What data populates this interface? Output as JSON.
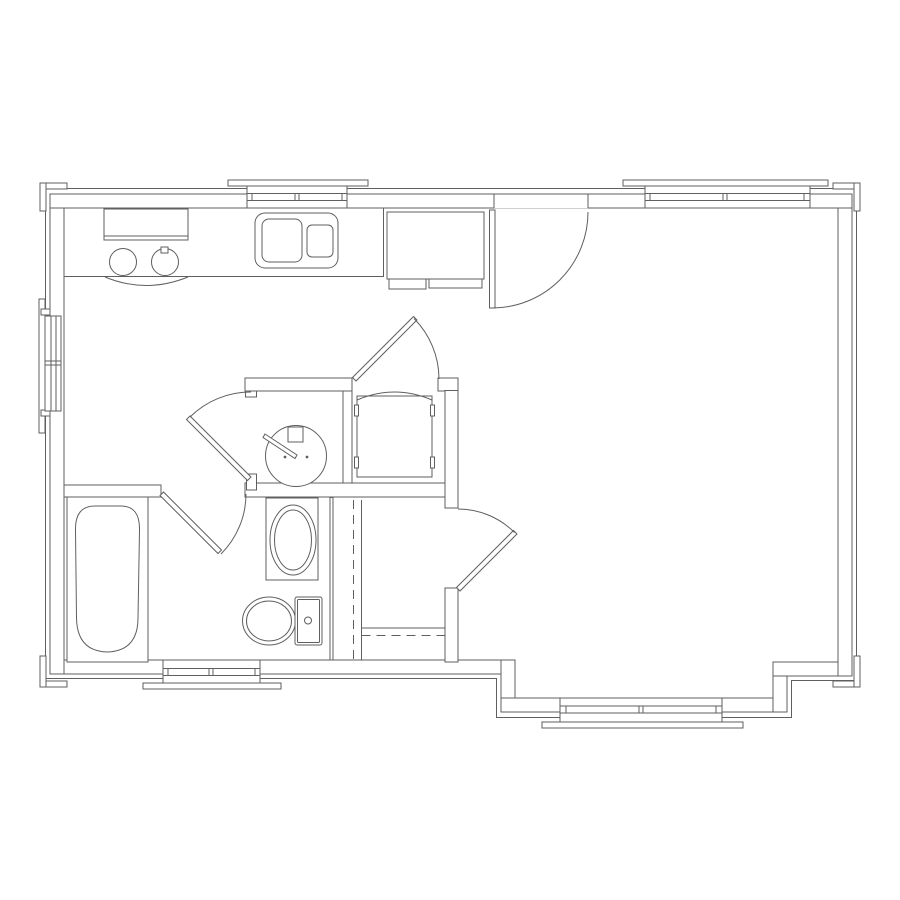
{
  "canvas": {
    "width": 900,
    "height": 900,
    "background": "#ffffff"
  },
  "style": {
    "line_color": "#5f5f5f",
    "line_width": 1,
    "dash": "9 6",
    "fill_white": "#ffffff"
  },
  "plan": {
    "groups": [
      {
        "name": "exterior-walls",
        "shapes": [
          {
            "t": "r",
            "x": 50,
            "y": 660,
            "w": 465,
            "h": 14,
            "f": 1
          },
          {
            "t": "r",
            "x": 501,
            "y": 660,
            "w": 14,
            "h": 52,
            "f": 1
          },
          {
            "t": "r",
            "x": 501,
            "y": 698,
            "w": 286,
            "h": 14,
            "f": 1
          },
          {
            "t": "r",
            "x": 773,
            "y": 662,
            "w": 14,
            "h": 50,
            "f": 1
          },
          {
            "t": "r",
            "x": 773,
            "y": 662,
            "w": 79,
            "h": 14,
            "f": 1
          },
          {
            "t": "r",
            "x": 50,
            "y": 194,
            "w": 14,
            "h": 480,
            "f": 1
          },
          {
            "t": "r",
            "x": 838,
            "y": 194,
            "w": 14,
            "h": 482,
            "f": 1
          },
          {
            "t": "r",
            "x": 50,
            "y": 194,
            "w": 802,
            "h": 14,
            "f": 1
          }
        ]
      },
      {
        "name": "siding-outline",
        "shapes": [
          {
            "t": "p",
            "d": "M45.5,188.5 H856.5 V680.5 H791.5 V717.5 H496.5 V678.5 H45.5 Z"
          }
        ]
      },
      {
        "name": "interior-walls",
        "shapes": [
          {
            "t": "r",
            "x": 245,
            "y": 483,
            "w": 213,
            "h": 14,
            "f": 1
          },
          {
            "t": "r",
            "x": 245,
            "y": 378,
            "w": 107,
            "h": 13,
            "f": 1
          },
          {
            "t": "r",
            "x": 438,
            "y": 378,
            "w": 20,
            "h": 13,
            "f": 1
          },
          {
            "t": "r",
            "x": 343,
            "y": 391,
            "w": 9,
            "h": 92,
            "f": 1
          },
          {
            "t": "r",
            "x": 445,
            "y": 390.5,
            "w": 13,
            "h": 117.5,
            "f": 1
          },
          {
            "t": "r",
            "x": 445,
            "y": 588,
            "w": 13,
            "h": 74,
            "f": 1
          },
          {
            "t": "r",
            "x": 64,
            "y": 485,
            "w": 97,
            "h": 12,
            "f": 1
          },
          {
            "t": "r",
            "x": 245.5,
            "y": 391,
            "w": 11,
            "h": 6,
            "f": 1
          },
          {
            "t": "r",
            "x": 246.5,
            "y": 474,
            "w": 10,
            "h": 16,
            "f": 1
          }
        ]
      },
      {
        "name": "entry-door",
        "shapes": [
          {
            "t": "r",
            "x": 494,
            "y": 194.6,
            "w": 94,
            "h": 13.6,
            "f": 1,
            "ns": 1
          },
          {
            "t": "l",
            "x1": 494,
            "y1": 194,
            "x2": 588,
            "y2": 194
          },
          {
            "t": "l",
            "x1": 494,
            "y1": 194.5,
            "x2": 494,
            "y2": 208
          },
          {
            "t": "l",
            "x1": 588,
            "y1": 194.5,
            "x2": 588,
            "y2": 208
          },
          {
            "t": "r",
            "x": 489.5,
            "y": 210,
            "w": 5.5,
            "h": 98,
            "f": 1
          },
          {
            "t": "p",
            "d": "M492,308 A96,96 0 0 0 588,212"
          }
        ]
      },
      {
        "name": "window-kitchen",
        "shapes": [
          {
            "t": "r",
            "x": 228,
            "y": 180,
            "w": 140,
            "h": 6,
            "f": 1
          },
          {
            "t": "r",
            "x": 247,
            "y": 186,
            "w": 100,
            "h": 22,
            "f": 1
          },
          {
            "t": "l",
            "x1": 247,
            "y1": 193.5,
            "x2": 347,
            "y2": 193.5
          },
          {
            "t": "l",
            "x1": 247,
            "y1": 200.5,
            "x2": 347,
            "y2": 200.5
          },
          {
            "t": "l",
            "x1": 252,
            "y1": 193.5,
            "x2": 252,
            "y2": 200.5
          },
          {
            "t": "l",
            "x1": 295,
            "y1": 193.5,
            "x2": 295,
            "y2": 200.5
          },
          {
            "t": "l",
            "x1": 299,
            "y1": 193.5,
            "x2": 299,
            "y2": 200.5
          },
          {
            "t": "l",
            "x1": 342,
            "y1": 193.5,
            "x2": 342,
            "y2": 200.5
          }
        ]
      },
      {
        "name": "window-greatroom-top",
        "shapes": [
          {
            "t": "r",
            "x": 623,
            "y": 180,
            "w": 205,
            "h": 6,
            "f": 1
          },
          {
            "t": "r",
            "x": 645,
            "y": 186,
            "w": 165,
            "h": 22,
            "f": 1
          },
          {
            "t": "l",
            "x1": 645,
            "y1": 193.5,
            "x2": 810,
            "y2": 193.5
          },
          {
            "t": "l",
            "x1": 645,
            "y1": 200.5,
            "x2": 810,
            "y2": 200.5
          },
          {
            "t": "l",
            "x1": 650,
            "y1": 193.5,
            "x2": 650,
            "y2": 200.5
          },
          {
            "t": "l",
            "x1": 723,
            "y1": 193.5,
            "x2": 723,
            "y2": 200.5
          },
          {
            "t": "l",
            "x1": 727,
            "y1": 193.5,
            "x2": 727,
            "y2": 200.5
          },
          {
            "t": "l",
            "x1": 804,
            "y1": 193.5,
            "x2": 804,
            "y2": 200.5
          }
        ]
      },
      {
        "name": "window-left",
        "shapes": [
          {
            "t": "r",
            "x": 39,
            "y": 299,
            "w": 6,
            "h": 134,
            "f": 1
          },
          {
            "t": "r",
            "x": 41,
            "y": 309,
            "w": 9,
            "h": 6,
            "f": 1
          },
          {
            "t": "r",
            "x": 41,
            "y": 410,
            "w": 9,
            "h": 6,
            "f": 1
          },
          {
            "t": "r",
            "x": 45,
            "y": 316,
            "w": 16,
            "h": 95,
            "f": 1
          },
          {
            "t": "l",
            "x1": 51,
            "y1": 316,
            "x2": 51,
            "y2": 411
          },
          {
            "t": "l",
            "x1": 56,
            "y1": 316,
            "x2": 56,
            "y2": 411
          },
          {
            "t": "l",
            "x1": 45,
            "y1": 361,
            "x2": 61,
            "y2": 361
          },
          {
            "t": "l",
            "x1": 45,
            "y1": 365,
            "x2": 61,
            "y2": 365
          }
        ]
      },
      {
        "name": "window-bath-bottom",
        "shapes": [
          {
            "t": "r",
            "x": 163,
            "y": 660,
            "w": 97,
            "h": 23,
            "f": 1
          },
          {
            "t": "r",
            "x": 143,
            "y": 683,
            "w": 138,
            "h": 6,
            "f": 1
          },
          {
            "t": "l",
            "x1": 163,
            "y1": 668.5,
            "x2": 260,
            "y2": 668.5
          },
          {
            "t": "l",
            "x1": 163,
            "y1": 675.5,
            "x2": 260,
            "y2": 675.5
          },
          {
            "t": "l",
            "x1": 168,
            "y1": 668.5,
            "x2": 168,
            "y2": 675.5
          },
          {
            "t": "l",
            "x1": 209,
            "y1": 668.5,
            "x2": 209,
            "y2": 675.5
          },
          {
            "t": "l",
            "x1": 213,
            "y1": 668.5,
            "x2": 213,
            "y2": 675.5
          },
          {
            "t": "l",
            "x1": 255,
            "y1": 668.5,
            "x2": 255,
            "y2": 675.5
          }
        ]
      },
      {
        "name": "window-bay",
        "shapes": [
          {
            "t": "r",
            "x": 560,
            "y": 698,
            "w": 162,
            "h": 24,
            "f": 1
          },
          {
            "t": "r",
            "x": 542,
            "y": 722,
            "w": 201,
            "h": 6,
            "f": 1
          },
          {
            "t": "l",
            "x1": 560,
            "y1": 706,
            "x2": 722,
            "y2": 706
          },
          {
            "t": "l",
            "x1": 560,
            "y1": 713,
            "x2": 722,
            "y2": 713
          },
          {
            "t": "l",
            "x1": 566,
            "y1": 706,
            "x2": 566,
            "y2": 713
          },
          {
            "t": "l",
            "x1": 639,
            "y1": 706,
            "x2": 639,
            "y2": 713
          },
          {
            "t": "l",
            "x1": 643,
            "y1": 706,
            "x2": 643,
            "y2": 713
          },
          {
            "t": "l",
            "x1": 716,
            "y1": 706,
            "x2": 716,
            "y2": 713
          }
        ]
      },
      {
        "name": "corner-trims",
        "shapes": [
          {
            "t": "r",
            "x": 40,
            "y": 183,
            "w": 27,
            "h": 6,
            "f": 1
          },
          {
            "t": "r",
            "x": 40,
            "y": 183,
            "w": 6,
            "h": 28,
            "f": 1
          },
          {
            "t": "r",
            "x": 833,
            "y": 183,
            "w": 27,
            "h": 6,
            "f": 1
          },
          {
            "t": "r",
            "x": 854,
            "y": 183,
            "w": 6,
            "h": 28,
            "f": 1
          },
          {
            "t": "r",
            "x": 40,
            "y": 681,
            "w": 27,
            "h": 6,
            "f": 1
          },
          {
            "t": "r",
            "x": 40,
            "y": 656,
            "w": 6,
            "h": 31,
            "f": 1
          },
          {
            "t": "r",
            "x": 833,
            "y": 681,
            "w": 27,
            "h": 6,
            "f": 1
          },
          {
            "t": "r",
            "x": 854,
            "y": 656,
            "w": 6,
            "h": 31,
            "f": 1
          }
        ]
      },
      {
        "name": "kitchen-counter",
        "shapes": [
          {
            "t": "l",
            "x1": 64,
            "y1": 276.5,
            "x2": 383,
            "y2": 276.5
          },
          {
            "t": "l",
            "x1": 383.5,
            "y1": 208,
            "x2": 383.5,
            "y2": 277
          }
        ]
      },
      {
        "name": "range",
        "shapes": [
          {
            "t": "r",
            "x": 104,
            "y": 209,
            "w": 84,
            "h": 31
          },
          {
            "t": "l",
            "x1": 104,
            "y1": 236,
            "x2": 188,
            "y2": 236
          },
          {
            "t": "c",
            "cx": 123,
            "cy": 262,
            "r": 13.5
          },
          {
            "t": "c",
            "cx": 165,
            "cy": 262,
            "r": 13.5
          },
          {
            "t": "r",
            "x": 161,
            "y": 247,
            "w": 7,
            "h": 6,
            "f": 1
          },
          {
            "t": "p",
            "d": "M105,277 Q146,294 188,277"
          }
        ]
      },
      {
        "name": "kitchen-sink",
        "shapes": [
          {
            "t": "r",
            "x": 255,
            "y": 213,
            "w": 83,
            "h": 55,
            "rx": 10
          },
          {
            "t": "r",
            "x": 262,
            "y": 219,
            "w": 40,
            "h": 43,
            "rx": 7
          },
          {
            "t": "r",
            "x": 307,
            "y": 225,
            "w": 26,
            "h": 32,
            "rx": 5
          }
        ]
      },
      {
        "name": "refrigerator",
        "shapes": [
          {
            "t": "r",
            "x": 387,
            "y": 212,
            "w": 97,
            "h": 67,
            "f": 1
          },
          {
            "t": "r",
            "x": 389,
            "y": 279,
            "w": 37,
            "h": 10
          },
          {
            "t": "r",
            "x": 429,
            "y": 279,
            "w": 53,
            "h": 9
          }
        ]
      },
      {
        "name": "round-basin",
        "shapes": [
          {
            "t": "c",
            "cx": 296,
            "cy": 456,
            "r": 30.5,
            "f": 1
          },
          {
            "t": "r",
            "x": 288,
            "y": 427,
            "w": 15,
            "h": 15,
            "f": 1
          },
          {
            "t": "g",
            "pts": "265,434 297,455 295,458.5 263,437.5",
            "f": 1
          },
          {
            "t": "c",
            "cx": 285,
            "cy": 457,
            "r": 1.4,
            "fd": 1,
            "ns": 1
          },
          {
            "t": "c",
            "cx": 307,
            "cy": 457,
            "r": 1.4,
            "fd": 1,
            "ns": 1
          }
        ]
      },
      {
        "name": "washer",
        "shapes": [
          {
            "t": "r",
            "x": 357,
            "y": 396,
            "w": 75,
            "h": 81,
            "f": 1
          },
          {
            "t": "p",
            "d": "M357,400 Q394.5,384 432,400"
          },
          {
            "t": "r",
            "x": 354.5,
            "y": 405,
            "w": 4,
            "h": 11,
            "f": 1
          },
          {
            "t": "r",
            "x": 430.5,
            "y": 405,
            "w": 4,
            "h": 11,
            "f": 1
          },
          {
            "t": "r",
            "x": 354.5,
            "y": 457,
            "w": 4,
            "h": 11,
            "f": 1
          },
          {
            "t": "r",
            "x": 430.5,
            "y": 457,
            "w": 4,
            "h": 11,
            "f": 1
          }
        ]
      },
      {
        "name": "vanity",
        "shapes": [
          {
            "t": "r",
            "x": 266,
            "y": 498,
            "w": 52,
            "h": 82,
            "f": 1
          },
          {
            "t": "e",
            "cx": 293,
            "cy": 540,
            "rx": 23,
            "ry": 35
          },
          {
            "t": "e",
            "cx": 293,
            "cy": 540,
            "rx": 18.5,
            "ry": 30
          }
        ]
      },
      {
        "name": "toilet",
        "shapes": [
          {
            "t": "e",
            "cx": 269,
            "cy": 621,
            "rx": 26.5,
            "ry": 24,
            "f": 1
          },
          {
            "t": "e",
            "cx": 269,
            "cy": 621,
            "rx": 22.5,
            "ry": 20
          },
          {
            "t": "r",
            "x": 295,
            "y": 597,
            "w": 27,
            "h": 48,
            "rx": 2,
            "f": 1
          },
          {
            "t": "r",
            "x": 297.5,
            "y": 599.5,
            "w": 22,
            "h": 43,
            "rx": 1
          },
          {
            "t": "c",
            "cx": 308,
            "cy": 620.5,
            "r": 3.5
          }
        ]
      },
      {
        "name": "bathtub",
        "shapes": [
          {
            "t": "r",
            "x": 67,
            "y": 497,
            "w": 81,
            "h": 165,
            "f": 1
          },
          {
            "t": "p",
            "d": "M95,506 L121,506 Q140,506 139.5,530 L138,618 Q138,651 107,652 Q77,651 76.5,618 L75.5,530 Q75,506 95,506 Z"
          }
        ]
      },
      {
        "name": "closet-shelving",
        "shapes": [
          {
            "t": "r",
            "x": 330,
            "y": 497.5,
            "w": 3,
            "h": 162.5,
            "f": 1
          },
          {
            "t": "l",
            "x1": 353.5,
            "y1": 500,
            "x2": 353.5,
            "y2": 660,
            "da": 1
          },
          {
            "t": "l",
            "x1": 361.5,
            "y1": 500,
            "x2": 361.5,
            "y2": 660
          },
          {
            "t": "l",
            "x1": 361.5,
            "y1": 628,
            "x2": 445,
            "y2": 628
          },
          {
            "t": "l",
            "x1": 361.5,
            "y1": 635.5,
            "x2": 445,
            "y2": 635.5,
            "da": 1
          }
        ]
      },
      {
        "name": "door-hall-bath",
        "shapes": [
          {
            "t": "g",
            "pts": "251,477 190,416 186.5,419.5 247.5,480.5",
            "f": 1
          },
          {
            "t": "p",
            "d": "M190,417 A86,86 0 0 1 251,392"
          }
        ]
      },
      {
        "name": "door-bathroom",
        "shapes": [
          {
            "t": "g",
            "pts": "160,495.5 218,553.5 221.5,550 163.5,492",
            "f": 1
          },
          {
            "t": "p",
            "d": "M221,554 A85,85 0 0 0 246,494"
          }
        ]
      },
      {
        "name": "door-wd-closet",
        "shapes": [
          {
            "t": "g",
            "pts": "352.5,377.5 413.5,316.5 417,320 356,381",
            "f": 1
          },
          {
            "t": "p",
            "d": "M414,318.5 A86,86 0 0 1 439,379"
          }
        ]
      },
      {
        "name": "door-closet-greatroom",
        "shapes": [
          {
            "t": "g",
            "pts": "456.5,587.5 513.5,530.5 517,534 460,591",
            "f": 1
          },
          {
            "t": "p",
            "d": "M458,509 A80,80 0 0 1 514.5,532.5"
          }
        ]
      }
    ]
  }
}
